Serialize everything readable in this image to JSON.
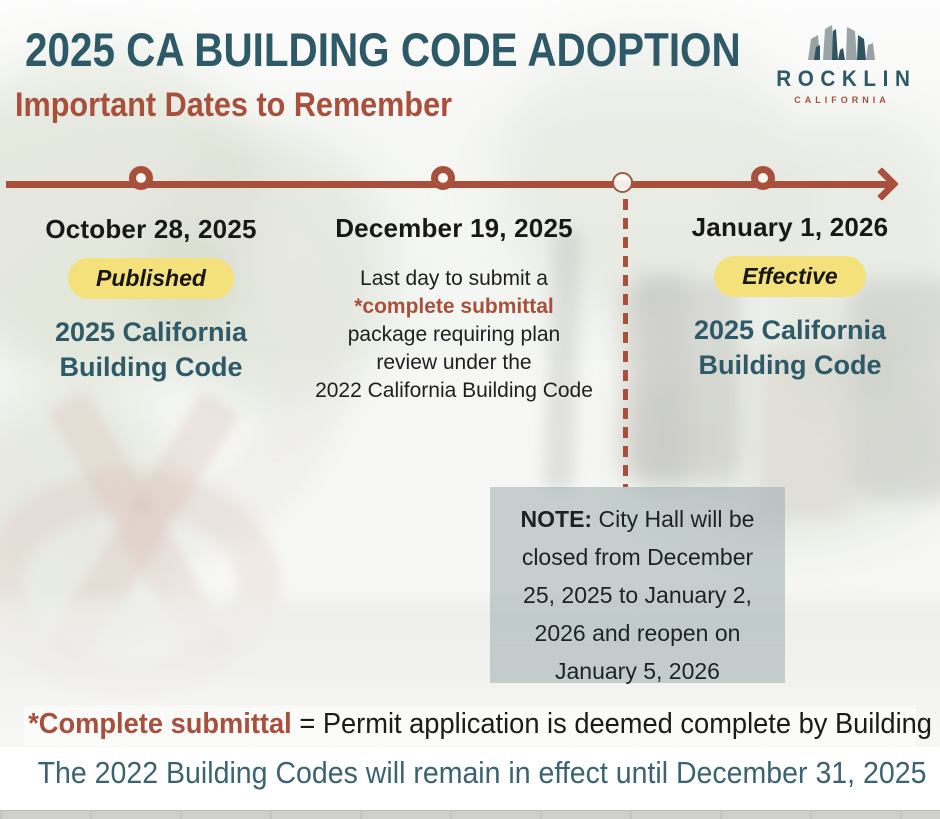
{
  "header": {
    "title": "2025 CA BUILDING CODE ADOPTION",
    "subtitle": "Important Dates to Remember"
  },
  "logo": {
    "icon": "rocklin-rocks-icon",
    "name": "ROCKLIN",
    "tagline": "CALIFORNIA"
  },
  "timeline": {
    "milestones": [
      {
        "date": "October 28, 2025",
        "badge": "Published",
        "program": "2025 California Building Code"
      },
      {
        "date": "December 19, 2025",
        "desc_line1": "Last day to submit a",
        "desc_highlight": "*complete submittal",
        "desc_lines_after": [
          "package requiring plan",
          "review under the",
          "2022 California Building Code"
        ]
      },
      {
        "date": "January 1, 2026",
        "badge": "Effective",
        "program": "2025 California Building Code"
      }
    ]
  },
  "note": {
    "label": "NOTE:",
    "line1_rest": " City Hall will be",
    "lines": [
      "closed from December",
      "25, 2025 to January 2,",
      "2026 and reopen on",
      "January 5, 2026"
    ]
  },
  "footnote": {
    "highlight": "*Complete submittal",
    "rest": " = Permit application is deemed complete by Building Staff"
  },
  "footer": {
    "text": "The 2022 Building Codes will remain in effect until December 31, 2025"
  },
  "colors": {
    "teal": "#2e5a68",
    "rust": "#a8503c",
    "badge_yellow": "#f5e17c",
    "note_bg": "rgba(154,168,172,0.52)"
  }
}
